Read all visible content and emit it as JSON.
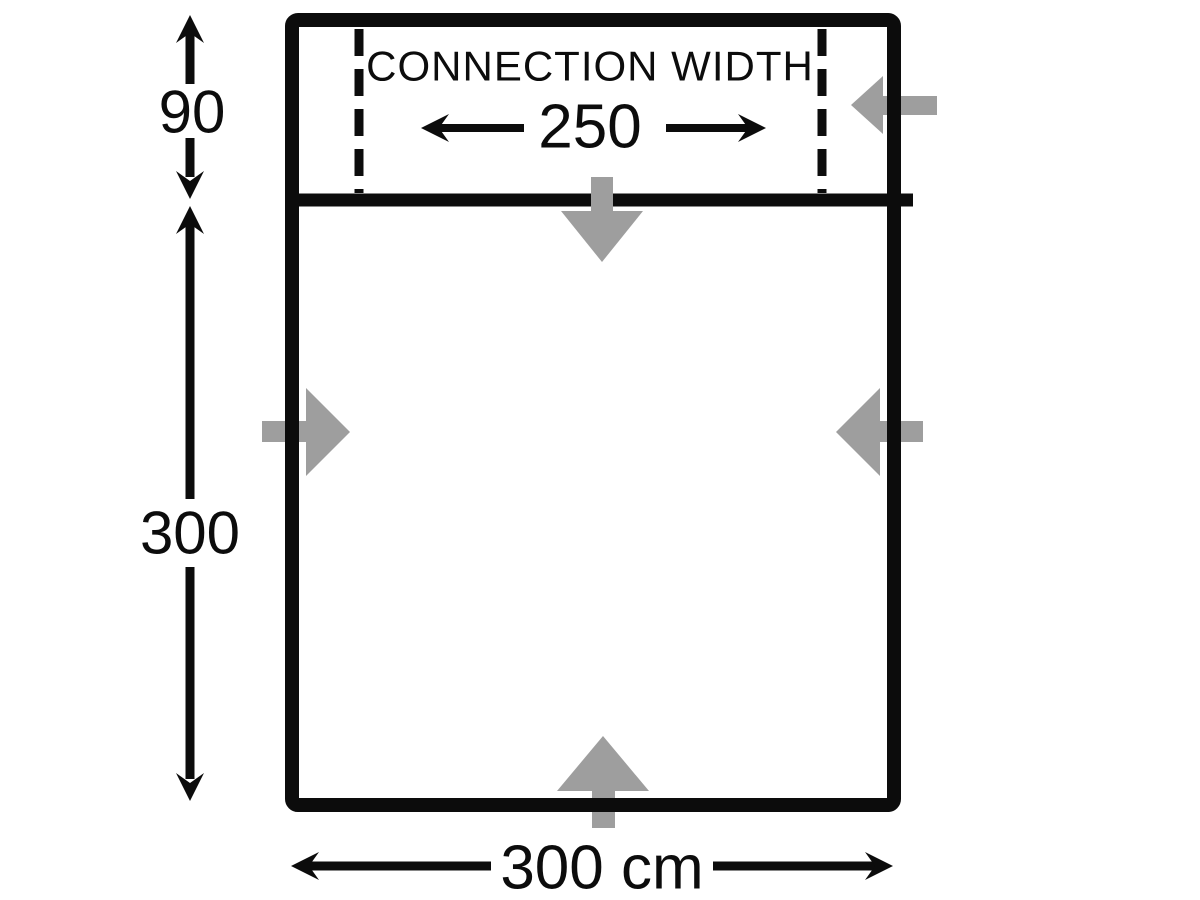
{
  "diagram": {
    "connection_label": "CONNECTION WIDTH",
    "connection_width_value": "250",
    "connection_depth_value": "90",
    "room_depth_value": "300",
    "total_width_value": "300 cm"
  },
  "colors": {
    "outline": "#0c0c0c",
    "entrance_arrow": "#9e9e9e",
    "background": "#ffffff"
  }
}
